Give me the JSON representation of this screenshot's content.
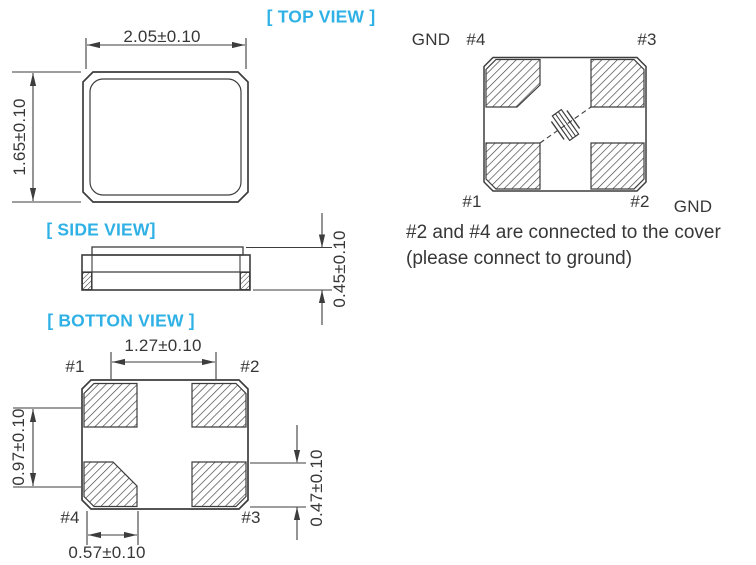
{
  "colors": {
    "accent_cyan": "#2fb1e6",
    "line": "#3d3d3d",
    "text": "#373737",
    "background": "#ffffff"
  },
  "top_view": {
    "label": "[ TOP VIEW ]",
    "width_dim": "2.05±0.10",
    "height_dim": "1.65±0.10"
  },
  "side_view": {
    "label": "[ SIDE VIEW]",
    "thickness_dim": "0.45±0.10"
  },
  "bottom_view": {
    "label": "[ BOTTON VIEW ]",
    "pitch_x_dim": "1.27±0.10",
    "pitch_y_dim": "0.97±0.10",
    "pad_height_dim": "0.47±0.10",
    "pad_width_dim": "0.57±0.10",
    "pin_top_left": "#1",
    "pin_top_right": "#2",
    "pin_bottom_left": "#4",
    "pin_bottom_right": "#3"
  },
  "pad_connection": {
    "gnd_top": "GND",
    "gnd_bottom": "GND",
    "pin_top_left": "#4",
    "pin_top_right": "#3",
    "pin_bottom_left": "#1",
    "pin_bottom_right": "#2",
    "note_line_1": "#2 and #4 are connected to the cover",
    "note_line_2": "(please connect to ground)"
  }
}
